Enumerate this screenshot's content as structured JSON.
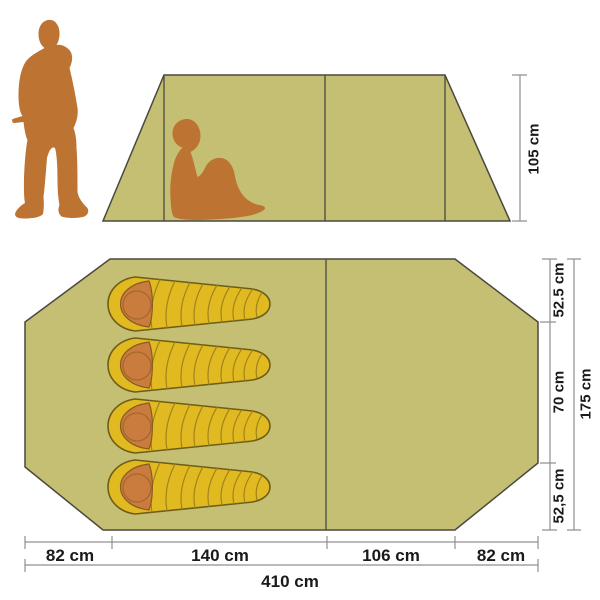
{
  "figure": {
    "type": "product-dimension-diagram",
    "subject": "camping tent with 4 sleeping bags, side elevation and floor plan with human silhouettes for scale",
    "sleeping_bag_count": 4
  },
  "side_view": {
    "height_label": "105 cm"
  },
  "floor_plan": {
    "width_total_label": "410 cm",
    "width_segment_labels": [
      "82 cm",
      "140 cm",
      "106 cm",
      "82 cm"
    ],
    "depth_total_label": "175 cm",
    "depth_segment_labels": [
      "52.5 cm",
      "70 cm",
      "52,5 cm"
    ]
  },
  "colors": {
    "background": "#ffffff",
    "tent_fabric": "#c4bf72",
    "tent_outline": "#4a493e",
    "person_silhouette": "#bd7331",
    "sleeping_bag_yellow": "#e0ba20",
    "sleeping_bag_outline": "#6e5d17",
    "sleeping_bag_segment_line": "#a1831c",
    "hood_orange": "#c97c3e",
    "dimension_line": "#909090",
    "label_text": "#1a1a1a"
  }
}
